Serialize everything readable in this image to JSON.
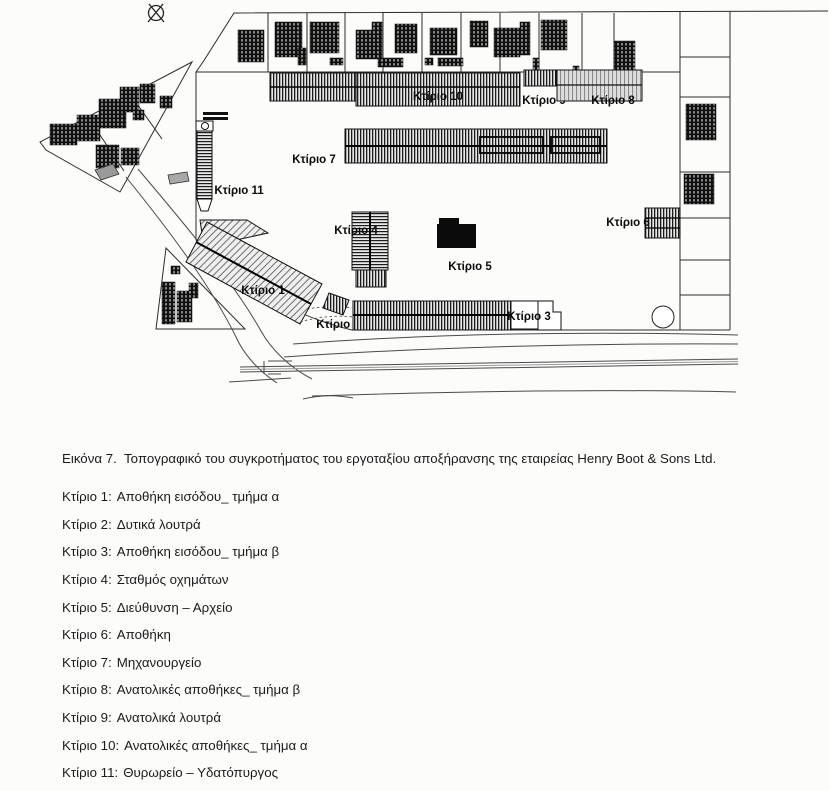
{
  "figure": {
    "compass_icon": "⊗",
    "labels": {
      "b1": "Κτίριο 1",
      "b2": "Κτίριο 2",
      "b3": "Κτίριο 3",
      "b4": "Κτίριο 4",
      "b5": "Κτίριο 5",
      "b6": "Κτίριο 6",
      "b7": "Κτίριο 7",
      "b8": "Κτίριο 8",
      "b9": "Κτίριο 9",
      "b10": "Κτίριο 10",
      "b11": "Κτίριο 11"
    }
  },
  "caption": {
    "text": "Εικόνα 7.  Τοπογραφικό του συγκροτήματος του εργοταξίου αποξήρανσης της εταιρείας Henry Boot & Sons Ltd."
  },
  "legend": {
    "items": [
      {
        "name": "Κτίριο 1:",
        "description": "Αποθήκη εισόδου_ τμήμα α"
      },
      {
        "name": "Κτίριο 2:",
        "description": "Δυτικά λουτρά"
      },
      {
        "name": "Κτίριο 3:",
        "description": "Αποθήκη εισόδου_ τμήμα β"
      },
      {
        "name": "Κτίριο 4:",
        "description": "Σταθμός οχημάτων"
      },
      {
        "name": "Κτίριο 5:",
        "description": "Διεύθυνση – Αρχείο"
      },
      {
        "name": "Κτίριο 6:",
        "description": "Αποθήκη"
      },
      {
        "name": "Κτίριο 7:",
        "description": "Μηχανουργείο"
      },
      {
        "name": "Κτίριο 8:",
        "description": "Ανατολικές αποθήκες_ τμήμα β"
      },
      {
        "name": "Κτίριο 9:",
        "description": "Ανατολικά λουτρά"
      },
      {
        "name": "Κτίριο 10:",
        "description": "Ανατολικές αποθήκες_ τμήμα α"
      },
      {
        "name": "Κτίριο 11:",
        "description": "Θυρωρείο – Υδατόπυργος"
      }
    ]
  }
}
